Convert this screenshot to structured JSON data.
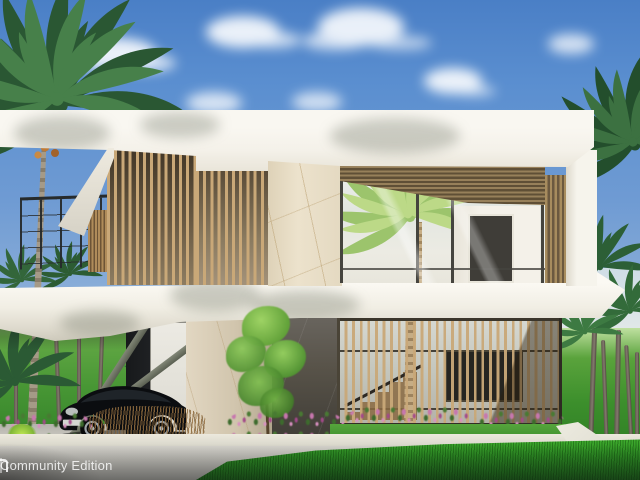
{
  "scene": {
    "subject": "Photorealistic architectural render of a modern two-story white villa with wooden slat screens, marble walls, a carport with a black sports car, tropical palm trees and landscaped garden under a blue sky"
  },
  "watermark": {
    "label": "Community Edition",
    "logo": "lumion-logo-fragment"
  },
  "colors": {
    "sky_top": "#4a7fc6",
    "sky_mid": "#6f9bd3",
    "sky_horizon": "#bcd3e4",
    "wall": "#f6f4ed",
    "wood": "#c9a878",
    "wood_dark": "#6b5940",
    "marble": "#e9dfc9",
    "stone": "#57534c",
    "grass": "#33a02c",
    "lawn": "#4f9c35",
    "flower": "#c777ae",
    "pavement": "#d4d2cb",
    "car": "#0c0d0f",
    "railing": "#2c2f30",
    "steel": "#6e7268",
    "palm": "#2e5c36",
    "palm_light": "#a9cc74",
    "trunk": "#8d8275",
    "watermark_text": "#ffffff"
  }
}
